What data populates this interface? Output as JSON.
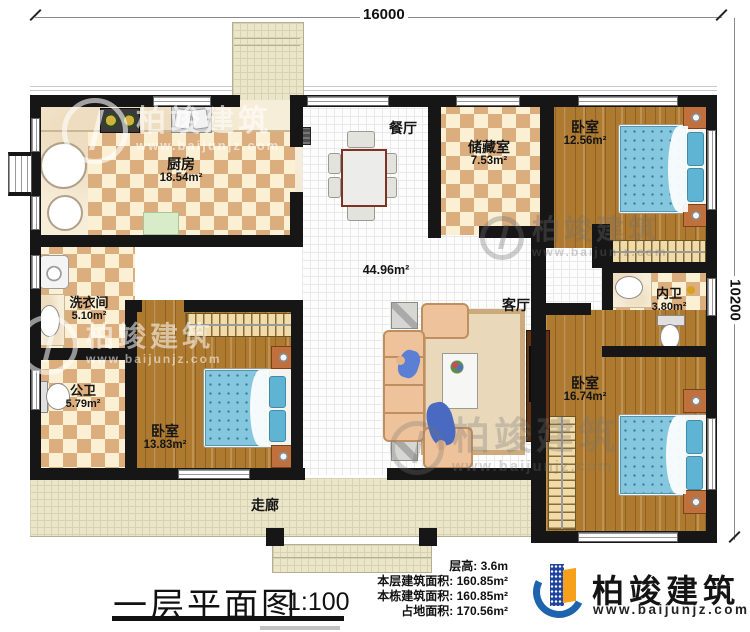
{
  "dimensions": {
    "top": "16000",
    "right": "10200"
  },
  "rooms": {
    "kitchen": {
      "name": "厨房",
      "area": "18.54m²"
    },
    "dining": {
      "name": "餐厅"
    },
    "storage": {
      "name": "储藏室",
      "area": "7.53m²"
    },
    "bedroom_top_right": {
      "name": "卧室",
      "area": "12.56m²"
    },
    "living": {
      "name": "客厅",
      "area": "44.96m²"
    },
    "ensuite": {
      "name": "内卫",
      "area": "3.80m²"
    },
    "laundry": {
      "name": "洗衣间",
      "area": "5.10m²"
    },
    "bath": {
      "name": "公卫",
      "area": "5.79m²"
    },
    "bedroom_bottom_left": {
      "name": "卧室",
      "area": "13.83m²"
    },
    "bedroom_bottom_right": {
      "name": "卧室",
      "area": "16.74m²"
    },
    "corridor": {
      "name": "走廊"
    }
  },
  "title_block": {
    "title": "一层平面图",
    "scale": "1:100"
  },
  "stats": [
    {
      "label": "层高:",
      "value": "3.6m"
    },
    {
      "label": "本层建筑面积:",
      "value": "160.85m²"
    },
    {
      "label": "本栋建筑面积:",
      "value": "160.85m²"
    },
    {
      "label": "占地面积:",
      "value": "170.56m²"
    }
  ],
  "brand": {
    "name": "柏竣建筑",
    "website": "www.baijunjz.com"
  },
  "watermark": {
    "name": "柏竣建筑",
    "website": "www.baijunjz.com"
  },
  "colors": {
    "wall": "#161616",
    "brand_blue": "#1e63ae",
    "brand_navy": "#21449e",
    "brand_orange": "#f7a11a",
    "mattress": "#85c7de",
    "wood": "#ae7a30"
  }
}
